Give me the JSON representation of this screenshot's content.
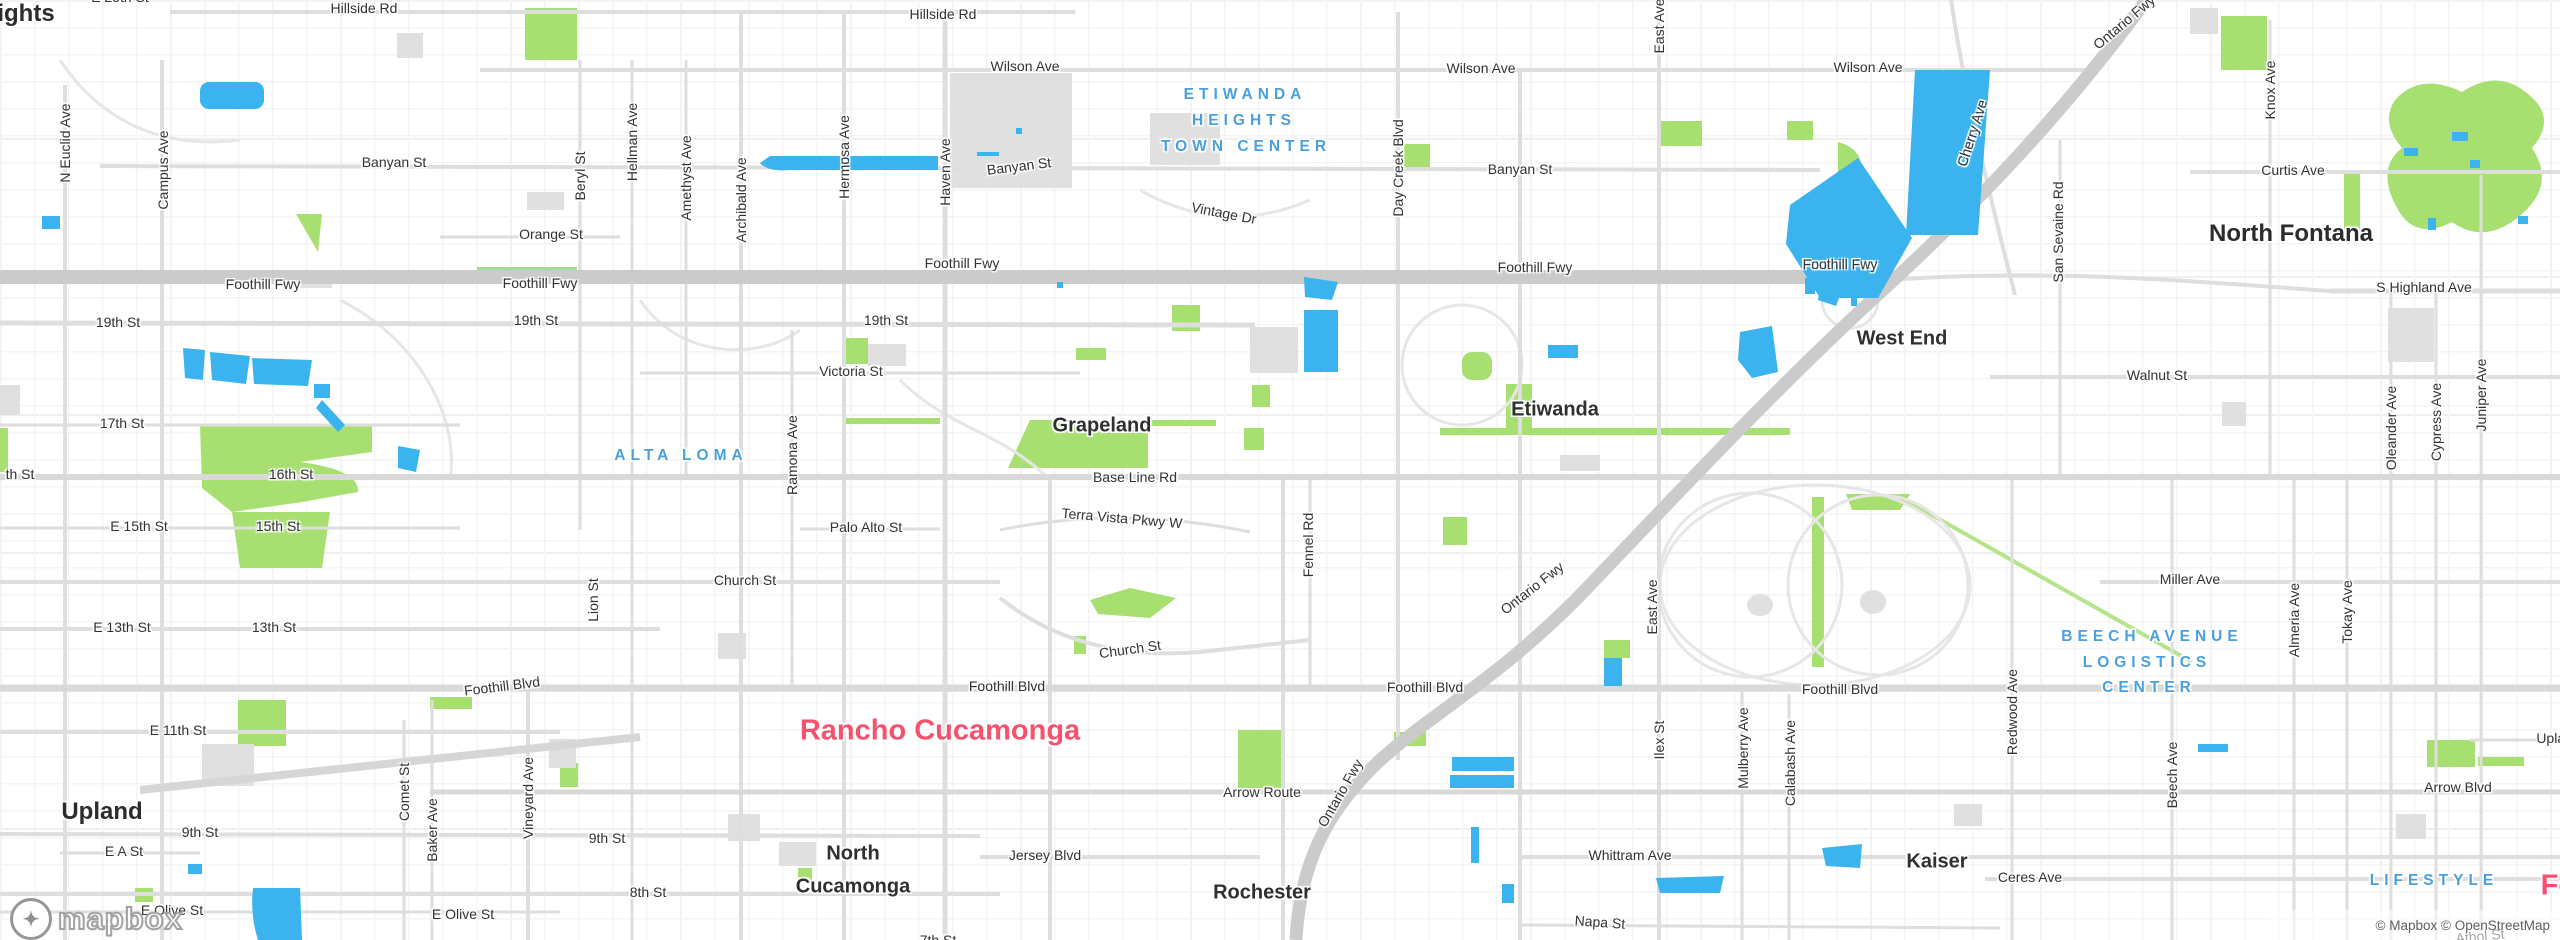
{
  "map": {
    "attribution": "© Mapbox © OpenStreetMap",
    "logo_word": "mapbox",
    "logo_icon": "✦",
    "colors": {
      "water": "#3ab3ee",
      "park": "#a7e070",
      "park_trail": "#b5e48a",
      "road_freeway": "#cbcbcb",
      "road_major": "#d9d9d9",
      "road_normal": "#dedede",
      "road_minor": "#e8e8e8",
      "gray_block": "#e0e0e0",
      "label_dark": "#333335",
      "label_city_pink": "#f8516e",
      "label_area_blue": "#4aa0dc"
    },
    "labels": [
      {
        "t": "E 25th St",
        "x": 120,
        "y": -3,
        "c": "st"
      },
      {
        "t": "ights",
        "x": 26,
        "y": 14,
        "c": "cityxl"
      },
      {
        "t": "Hillside Rd",
        "x": 364,
        "y": 8,
        "c": "st"
      },
      {
        "t": "Hillside Rd",
        "x": 943,
        "y": 14,
        "c": "st"
      },
      {
        "t": "Wilson Ave",
        "x": 1025,
        "y": 66,
        "c": "st"
      },
      {
        "t": "Wilson Ave",
        "x": 1481,
        "y": 68,
        "c": "st"
      },
      {
        "t": "Wilson Ave",
        "x": 1868,
        "y": 67,
        "c": "st"
      },
      {
        "t": "Banyan St",
        "x": 394,
        "y": 162,
        "c": "st"
      },
      {
        "t": "Banyan St",
        "x": 1019,
        "y": 166,
        "r": -7,
        "c": "st"
      },
      {
        "t": "Banyan St",
        "x": 1520,
        "y": 169,
        "c": "st"
      },
      {
        "t": "Orange St",
        "x": 551,
        "y": 234,
        "c": "st"
      },
      {
        "t": "Vintage Dr",
        "x": 1224,
        "y": 213,
        "r": 11,
        "c": "st"
      },
      {
        "t": "Curtis Ave",
        "x": 2293,
        "y": 170,
        "c": "st"
      },
      {
        "t": "North Fontana",
        "x": 2291,
        "y": 234,
        "c": "cityxl"
      },
      {
        "t": "ETIWANDA",
        "x": 1245,
        "y": 95,
        "c": "area"
      },
      {
        "t": "HEIGHTS",
        "x": 1244,
        "y": 121,
        "c": "area"
      },
      {
        "t": "TOWN CENTER",
        "x": 1246,
        "y": 147,
        "c": "area"
      },
      {
        "t": "Foothill Fwy",
        "x": 263,
        "y": 284,
        "c": "st"
      },
      {
        "t": "Foothill Fwy",
        "x": 540,
        "y": 283,
        "c": "st"
      },
      {
        "t": "Foothill Fwy",
        "x": 962,
        "y": 263,
        "c": "st"
      },
      {
        "t": "Foothill Fwy",
        "x": 1535,
        "y": 267,
        "c": "st"
      },
      {
        "t": "Foothill Fwy",
        "x": 1840,
        "y": 264,
        "c": "st"
      },
      {
        "t": "S Highland Ave",
        "x": 2424,
        "y": 287,
        "c": "st"
      },
      {
        "t": "19th St",
        "x": 118,
        "y": 322,
        "c": "st"
      },
      {
        "t": "19th St",
        "x": 536,
        "y": 320,
        "c": "st"
      },
      {
        "t": "19th St",
        "x": 886,
        "y": 320,
        "c": "st"
      },
      {
        "t": "Victoria St",
        "x": 851,
        "y": 371,
        "c": "st"
      },
      {
        "t": "Walnut St",
        "x": 2157,
        "y": 375,
        "c": "st"
      },
      {
        "t": "West End",
        "x": 1902,
        "y": 339,
        "c": "city"
      },
      {
        "t": "Etiwanda",
        "x": 1555,
        "y": 410,
        "c": "city"
      },
      {
        "t": "Grapeland",
        "x": 1102,
        "y": 426,
        "c": "city"
      },
      {
        "t": "ALTA LOMA",
        "x": 681,
        "y": 456,
        "c": "area"
      },
      {
        "t": "Base Line Rd",
        "x": 1135,
        "y": 477,
        "c": "st"
      },
      {
        "t": "16th St",
        "x": 291,
        "y": 474,
        "c": "st"
      },
      {
        "t": "th St",
        "x": 20,
        "y": 474,
        "c": "st"
      },
      {
        "t": "E 15th St",
        "x": 139,
        "y": 526,
        "c": "st"
      },
      {
        "t": "15th St",
        "x": 278,
        "y": 526,
        "c": "st"
      },
      {
        "t": "Palo Alto St",
        "x": 866,
        "y": 527,
        "c": "st"
      },
      {
        "t": "Terra Vista Pkwy W",
        "x": 1122,
        "y": 518,
        "r": 5,
        "c": "st"
      },
      {
        "t": "17th St",
        "x": 122,
        "y": 423,
        "c": "st"
      },
      {
        "t": "Church St",
        "x": 745,
        "y": 580,
        "c": "st"
      },
      {
        "t": "Church St",
        "x": 1130,
        "y": 649,
        "r": -8,
        "c": "st"
      },
      {
        "t": "E 13th St",
        "x": 122,
        "y": 627,
        "c": "st"
      },
      {
        "t": "13th St",
        "x": 274,
        "y": 627,
        "c": "st"
      },
      {
        "t": "Miller Ave",
        "x": 2190,
        "y": 579,
        "c": "st"
      },
      {
        "t": "BEECH AVENUE",
        "x": 2152,
        "y": 637,
        "c": "area"
      },
      {
        "t": "LOGISTICS",
        "x": 2147,
        "y": 663,
        "c": "area"
      },
      {
        "t": "CENTER",
        "x": 2149,
        "y": 688,
        "c": "area"
      },
      {
        "t": "E 11th St",
        "x": 178,
        "y": 730,
        "c": "st"
      },
      {
        "t": "Foothill Blvd",
        "x": 502,
        "y": 686,
        "r": -7,
        "c": "st"
      },
      {
        "t": "Foothill Blvd",
        "x": 1007,
        "y": 686,
        "c": "st"
      },
      {
        "t": "Foothill Blvd",
        "x": 1425,
        "y": 687,
        "c": "st"
      },
      {
        "t": "Foothill Blvd",
        "x": 1840,
        "y": 689,
        "c": "st"
      },
      {
        "t": "Rancho Cucamonga",
        "x": 940,
        "y": 731,
        "c": "pink"
      },
      {
        "t": "Arrow Route",
        "x": 1262,
        "y": 792,
        "c": "st"
      },
      {
        "t": "Arrow Blvd",
        "x": 2458,
        "y": 787,
        "c": "st"
      },
      {
        "t": "Upland Ave",
        "x": 2572,
        "y": 738,
        "c": "st"
      },
      {
        "t": "Upland",
        "x": 102,
        "y": 812,
        "c": "cityxl"
      },
      {
        "t": "9th St",
        "x": 200,
        "y": 832,
        "c": "st"
      },
      {
        "t": "9th St",
        "x": 607,
        "y": 838,
        "c": "st"
      },
      {
        "t": "E A St",
        "x": 124,
        "y": 851,
        "c": "st"
      },
      {
        "t": "8th St",
        "x": 648,
        "y": 892,
        "c": "st"
      },
      {
        "t": "North",
        "x": 853,
        "y": 854,
        "c": "city"
      },
      {
        "t": "Cucamonga",
        "x": 853,
        "y": 887,
        "c": "city"
      },
      {
        "t": "Jersey Blvd",
        "x": 1045,
        "y": 855,
        "c": "st"
      },
      {
        "t": "Rochester",
        "x": 1262,
        "y": 893,
        "c": "city"
      },
      {
        "t": "Whittram Ave",
        "x": 1630,
        "y": 855,
        "c": "st"
      },
      {
        "t": "Napa St",
        "x": 1600,
        "y": 922,
        "r": 4,
        "c": "st"
      },
      {
        "t": "Kaiser",
        "x": 1937,
        "y": 862,
        "c": "city"
      },
      {
        "t": "Ceres Ave",
        "x": 2030,
        "y": 877,
        "c": "st"
      },
      {
        "t": "E Olive St",
        "x": 172,
        "y": 910,
        "c": "st"
      },
      {
        "t": "E Olive St",
        "x": 463,
        "y": 914,
        "c": "st"
      },
      {
        "t": "7th St",
        "x": 938,
        "y": 940,
        "c": "st"
      },
      {
        "t": "Athol St",
        "x": 2480,
        "y": 936,
        "r": -6,
        "c": "st"
      },
      {
        "t": "LIFESTYLE",
        "x": 2434,
        "y": 881,
        "c": "area"
      },
      {
        "t": "Fontana",
        "x": 2597,
        "y": 886,
        "c": "pink"
      },
      {
        "t": "Ontario Fwy",
        "x": 2124,
        "y": 22,
        "r": -40,
        "c": "st"
      },
      {
        "t": "Ontario Fwy",
        "x": 1532,
        "y": 588,
        "r": -38,
        "c": "st"
      },
      {
        "t": "Ontario Fwy",
        "x": 1340,
        "y": 793,
        "r": -60,
        "c": "st"
      },
      {
        "t": "N Euclid Ave",
        "x": 65,
        "y": 143,
        "r": -90,
        "c": "st"
      },
      {
        "t": "Campus Ave",
        "x": 163,
        "y": 170,
        "r": -90,
        "c": "st"
      },
      {
        "t": "Beryl St",
        "x": 580,
        "y": 176,
        "r": -90,
        "c": "st"
      },
      {
        "t": "Hellman Ave",
        "x": 632,
        "y": 142,
        "r": -90,
        "c": "st"
      },
      {
        "t": "Amethyst Ave",
        "x": 686,
        "y": 178,
        "r": -90,
        "c": "st"
      },
      {
        "t": "Archibald Ave",
        "x": 741,
        "y": 200,
        "r": -90,
        "c": "st"
      },
      {
        "t": "Hermosa Ave",
        "x": 844,
        "y": 157,
        "r": -90,
        "c": "st"
      },
      {
        "t": "Haven Ave",
        "x": 945,
        "y": 172,
        "r": -90,
        "c": "st"
      },
      {
        "t": "Day Creek Blvd",
        "x": 1398,
        "y": 168,
        "r": -90,
        "c": "st"
      },
      {
        "t": "East Ave",
        "x": 1659,
        "y": 26,
        "r": -90,
        "c": "st"
      },
      {
        "t": "Cherry Ave",
        "x": 1972,
        "y": 133,
        "r": -72,
        "c": "st"
      },
      {
        "t": "San Sevaine Rd",
        "x": 2058,
        "y": 232,
        "r": -90,
        "c": "st"
      },
      {
        "t": "Knox Ave",
        "x": 2270,
        "y": 90,
        "r": -90,
        "c": "st"
      },
      {
        "t": "Oleander Ave",
        "x": 2391,
        "y": 428,
        "r": -90,
        "c": "st"
      },
      {
        "t": "Cypress Ave",
        "x": 2436,
        "y": 422,
        "r": -90,
        "c": "st"
      },
      {
        "t": "Juniper Ave",
        "x": 2481,
        "y": 395,
        "r": -90,
        "c": "st"
      },
      {
        "t": "Almeria Ave",
        "x": 2294,
        "y": 620,
        "r": -90,
        "c": "st"
      },
      {
        "t": "Tokay Ave",
        "x": 2347,
        "y": 612,
        "r": -90,
        "c": "st"
      },
      {
        "t": "Beech Ave",
        "x": 2172,
        "y": 775,
        "r": -90,
        "c": "st"
      },
      {
        "t": "Redwood Ave",
        "x": 2012,
        "y": 712,
        "r": -90,
        "c": "st"
      },
      {
        "t": "Mulberry Ave",
        "x": 1743,
        "y": 748,
        "r": -90,
        "c": "st"
      },
      {
        "t": "Calabash Ave",
        "x": 1790,
        "y": 763,
        "r": -90,
        "c": "st"
      },
      {
        "t": "Ilex St",
        "x": 1659,
        "y": 740,
        "r": -90,
        "c": "st"
      },
      {
        "t": "Fennel Rd",
        "x": 1308,
        "y": 545,
        "r": -90,
        "c": "st"
      },
      {
        "t": "East Ave",
        "x": 1652,
        "y": 607,
        "r": -90,
        "c": "st"
      },
      {
        "t": "Ramona Ave",
        "x": 792,
        "y": 455,
        "r": -90,
        "c": "st"
      },
      {
        "t": "Lion St",
        "x": 593,
        "y": 600,
        "r": -90,
        "c": "st"
      },
      {
        "t": "Vineyard Ave",
        "x": 528,
        "y": 798,
        "r": -90,
        "c": "st"
      },
      {
        "t": "Baker Ave",
        "x": 432,
        "y": 830,
        "r": -90,
        "c": "st"
      },
      {
        "t": "Comet St",
        "x": 404,
        "y": 792,
        "r": -90,
        "c": "st"
      }
    ]
  }
}
